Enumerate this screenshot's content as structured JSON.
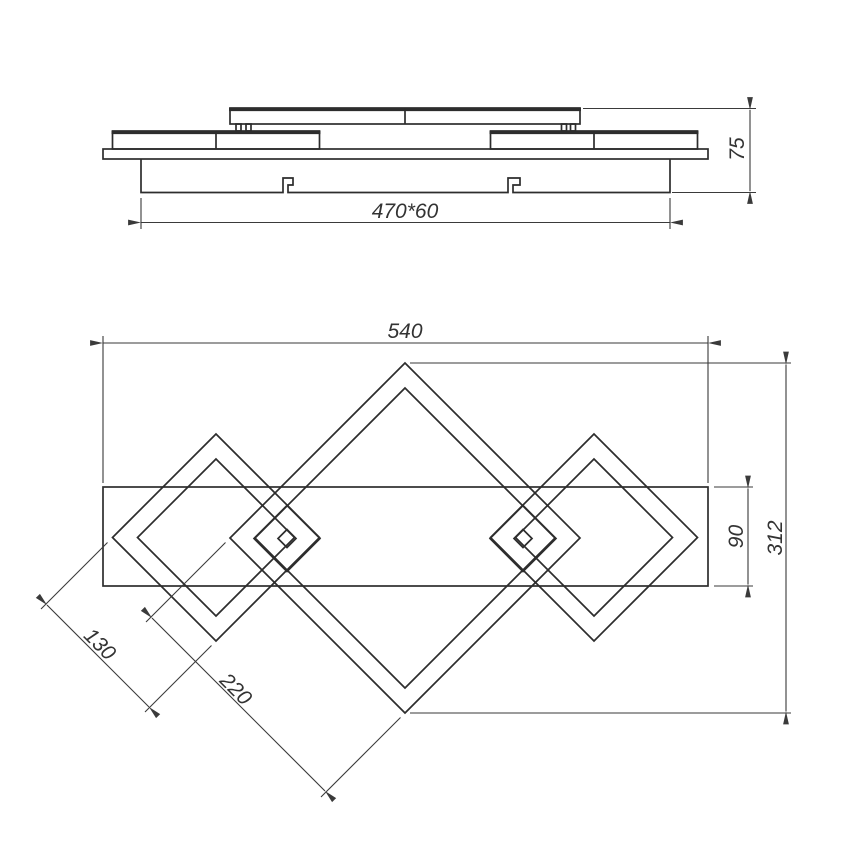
{
  "colors": {
    "line": "#2d2d2d",
    "dim": "#3a3a3a",
    "text": "#333333",
    "background": "#ffffff"
  },
  "side_view": {
    "labels": {
      "mount_size": "470*60",
      "total_height": "75"
    }
  },
  "plan_view": {
    "labels": {
      "overall_width": "540",
      "overall_height": "312",
      "band_width": "90",
      "small_diamond_side": "130",
      "large_diamond_side": "220"
    }
  }
}
